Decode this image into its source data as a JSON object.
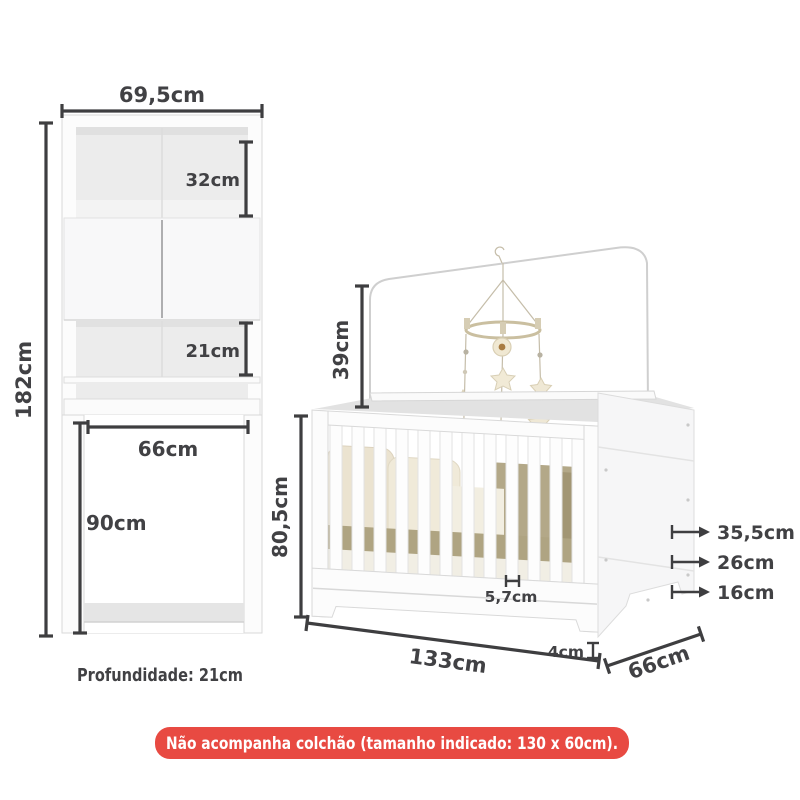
{
  "cabinet": {
    "width": "69,5cm",
    "height": "182cm",
    "top_shelf_height": "32cm",
    "lower_shelf_height": "21cm",
    "opening_width": "66cm",
    "opening_height": "90cm",
    "depth_note": "Profundidade: 21cm"
  },
  "crib": {
    "canopy_height": "39cm",
    "height": "80,5cm",
    "slat_gap": "5,7cm",
    "width": "133cm",
    "base_height": "4cm",
    "depth": "66cm",
    "mattress_levels": [
      "35,5cm",
      "26cm",
      "16cm"
    ]
  },
  "banner": {
    "text": "Não acompanha colchão (tamanho indicado: 130 x 60cm).",
    "background": "#e84a42",
    "text_color": "#ffffff"
  },
  "colors": {
    "dimension": "#3e3e40",
    "furniture_outline": "#d9d9d9",
    "bedding_khaki": "#b2a785",
    "bedding_cream": "#efe8d7"
  }
}
